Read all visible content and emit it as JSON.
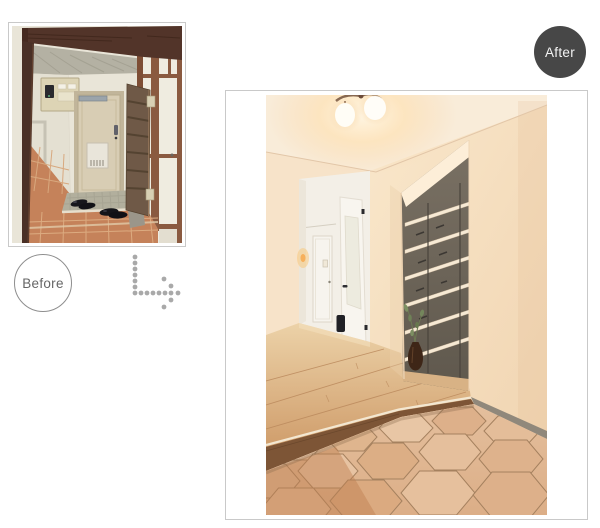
{
  "labels": {
    "before": "Before",
    "after": "After"
  },
  "photos": {
    "before_name": "old-entryway-photo",
    "after_name": "renovated-entryway-photo"
  },
  "colors": {
    "page-bg": "#ffffff",
    "card-border": "#c9c9c9",
    "after-badge-bg": "#474747",
    "after-badge-text": "#f2f2f2",
    "before-badge-border": "#8e8e8e",
    "before-badge-text": "#666666",
    "arrow-dot": "#a9a9a9"
  }
}
